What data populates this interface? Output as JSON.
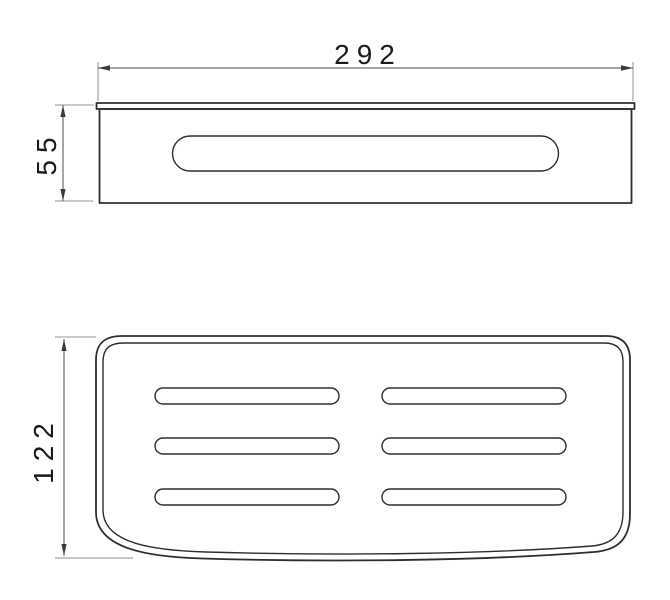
{
  "page": {
    "background": "#ffffff"
  },
  "dimensions": {
    "width": {
      "label": "292"
    },
    "height": {
      "label": "55"
    },
    "depth": {
      "label": "122"
    }
  },
  "colors": {
    "figure_line": "#2e2e2e",
    "dimension_line": "#4d4d4d",
    "extension_line": "#909090",
    "label_text": "#1a1a1a",
    "background": "#ffffff"
  }
}
